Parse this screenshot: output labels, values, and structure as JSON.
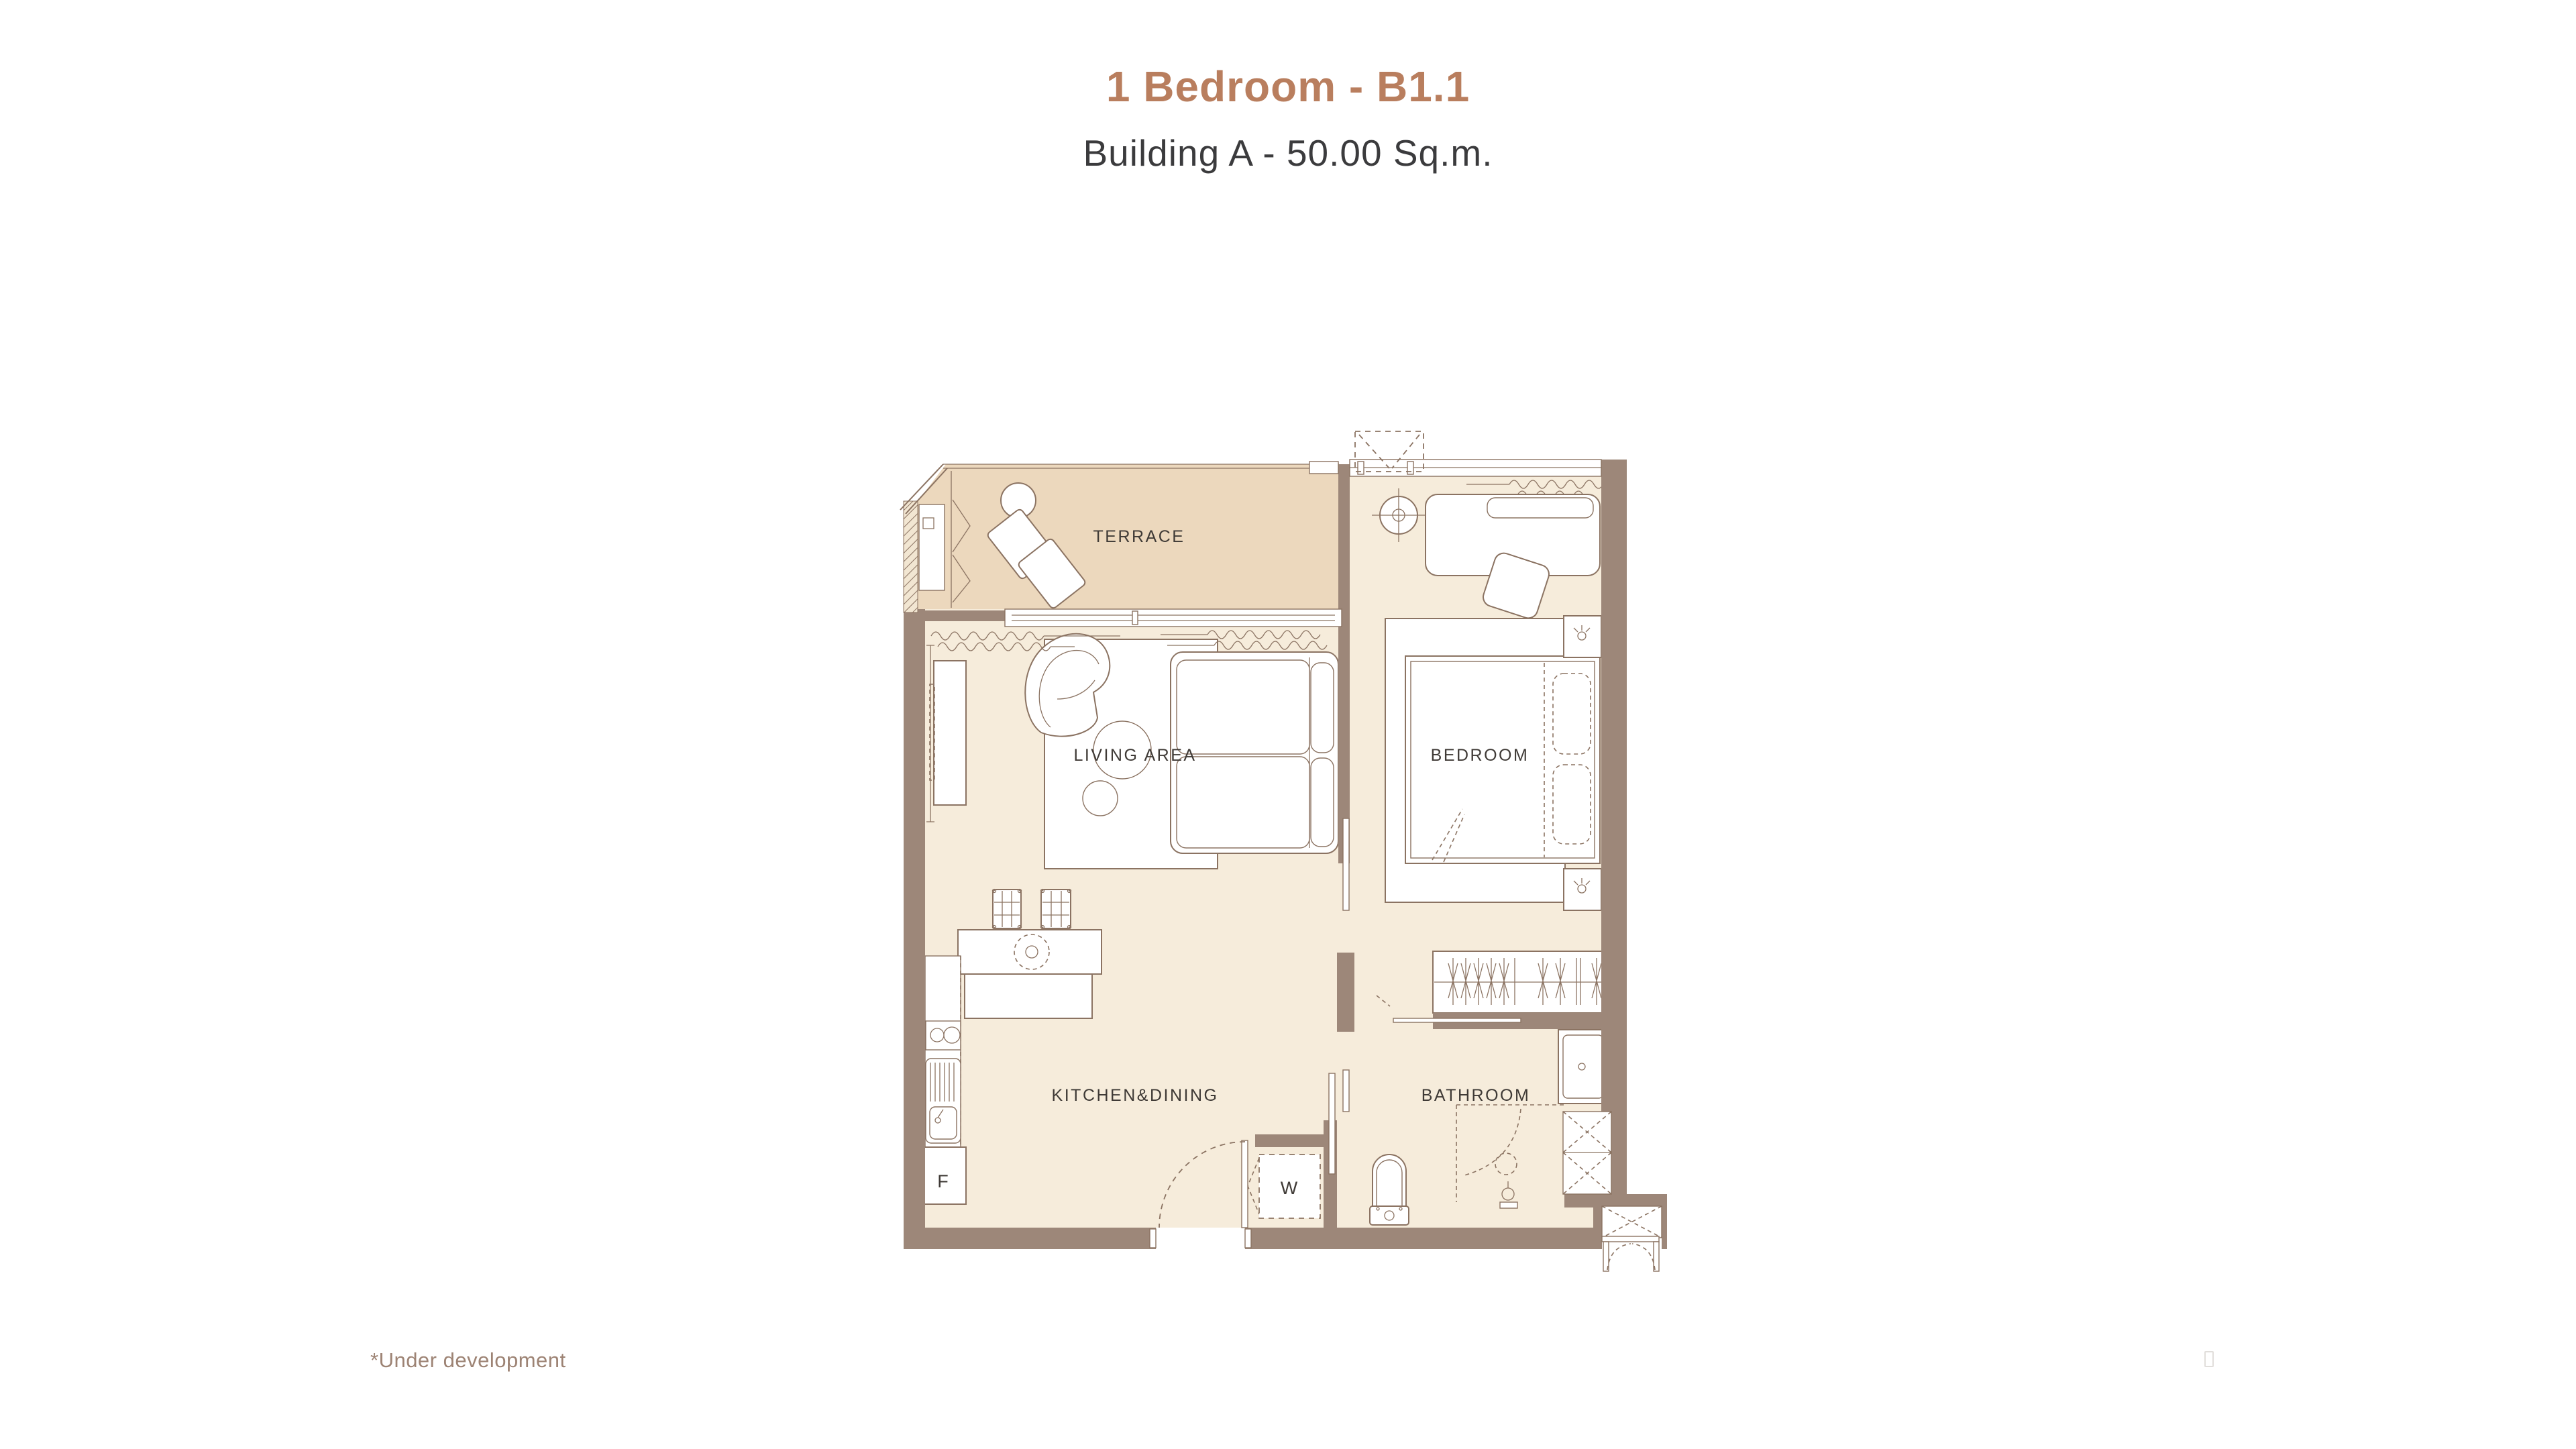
{
  "page": {
    "title": "1 Bedroom - B1.1",
    "subtitle": "Building A - 50.00 Sq.m.",
    "footnote": "*Under development"
  },
  "floor_plan": {
    "rooms": {
      "terrace": "TERRACE",
      "living_area": "LIVING AREA",
      "bedroom": "BEDROOM",
      "kitchen_dining": "KITCHEN&DINING",
      "bathroom": "BATHROOM"
    },
    "appliances": {
      "fridge": "F",
      "washer": "W"
    },
    "colors": {
      "title_accent": "#b97e5e",
      "subtitle_text": "#3b3b3d",
      "wall": "#9d8779",
      "interior_floor": "#f6ecdb",
      "terrace_floor": "#ecd8bd",
      "outline": "#8b7362",
      "room_label": "#3f3a36",
      "footnote_text": "#9d8374"
    }
  }
}
